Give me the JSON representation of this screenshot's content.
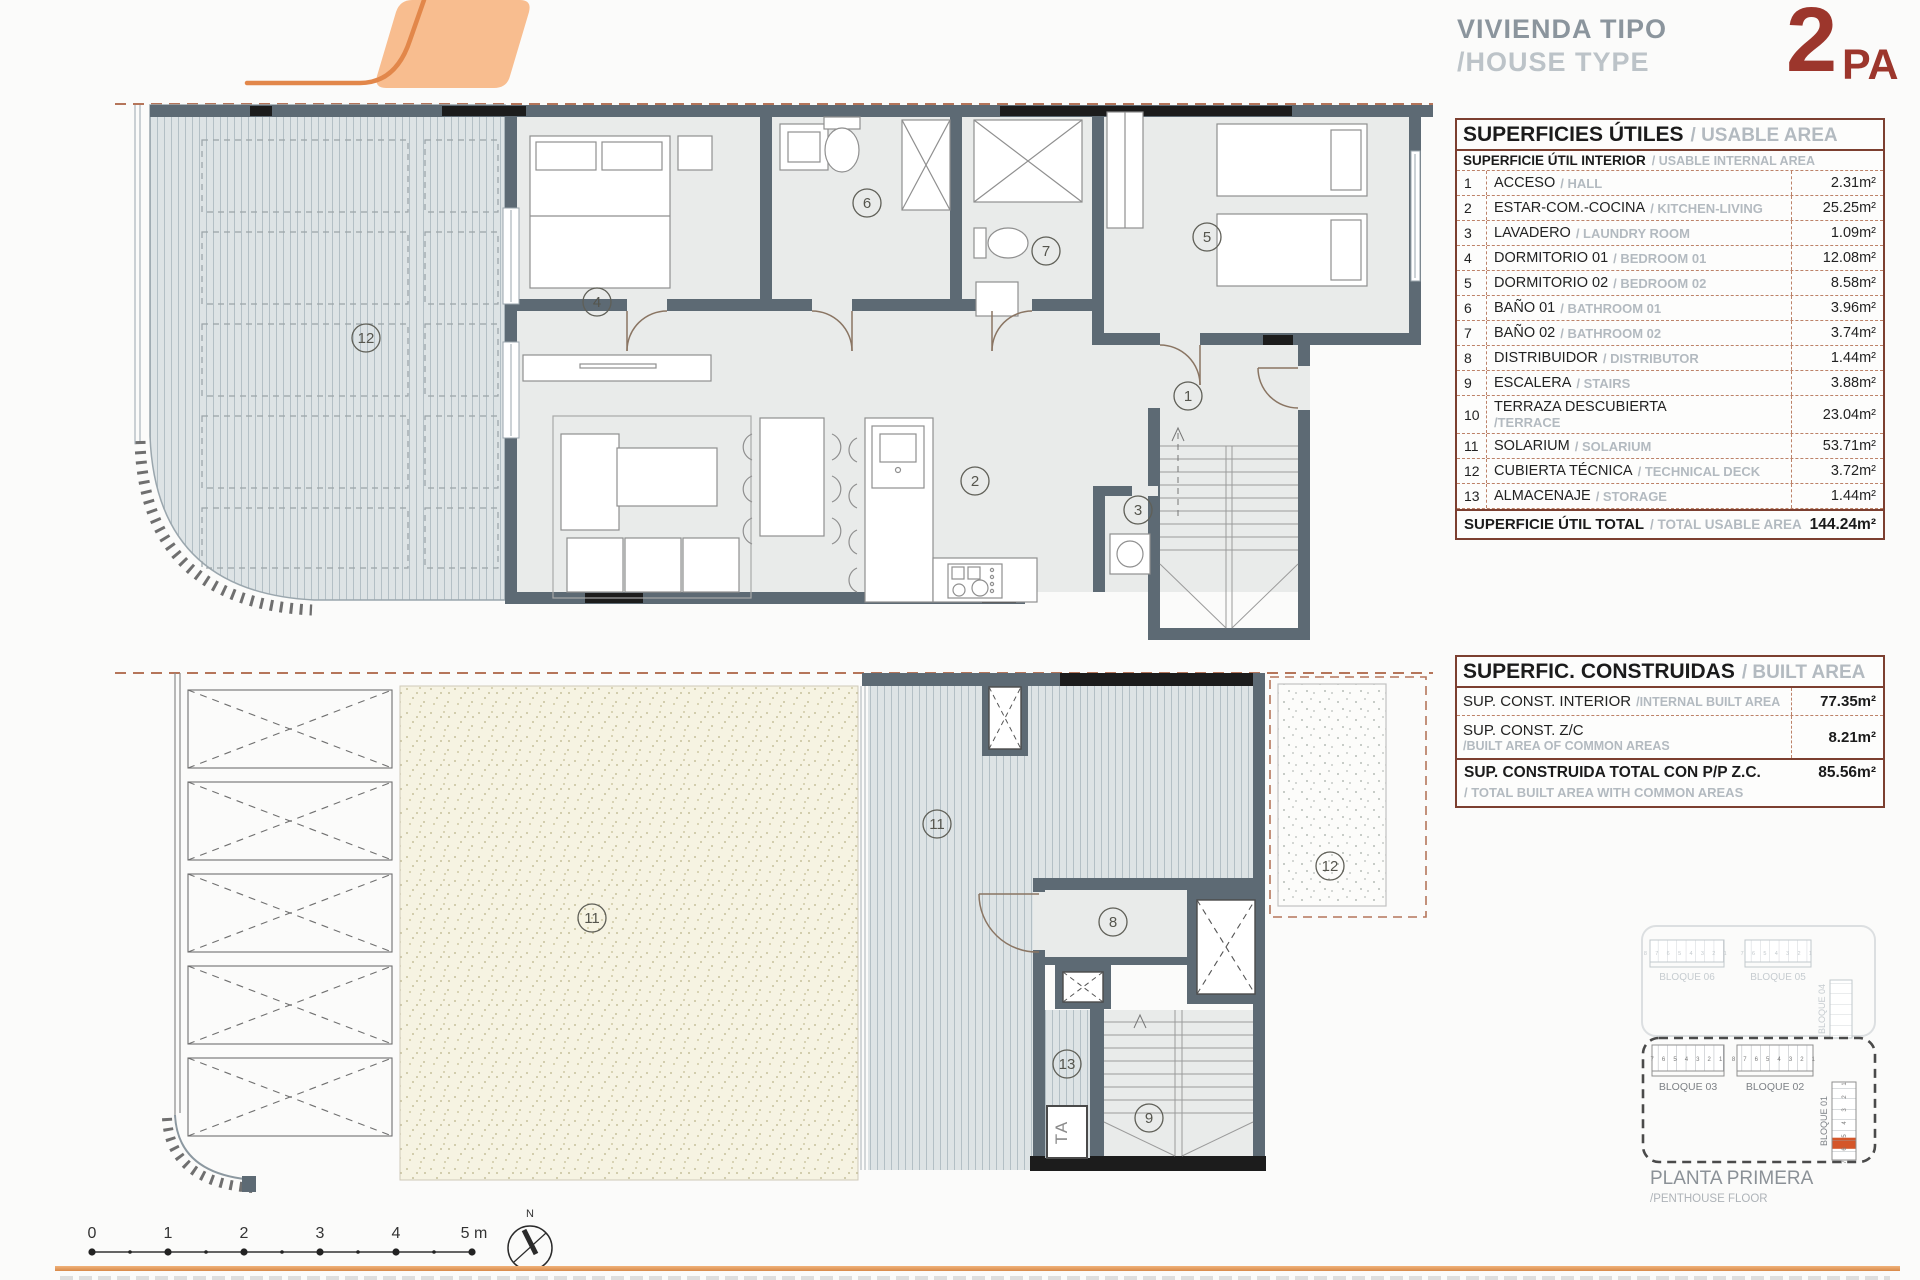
{
  "header": {
    "title_line1": "VIVIENDA TIPO",
    "title_line2": "/HOUSE TYPE",
    "type_number": "2",
    "type_suffix": "PA",
    "accent_red": "#9c362c",
    "accent_orange": "#e2874a"
  },
  "usable_table": {
    "title_es": "SUPERFICIES ÚTILES",
    "title_en": "/ USABLE AREA",
    "subtitle_es": "SUPERFICIE ÚTIL INTERIOR",
    "subtitle_en": "/ USABLE INTERNAL AREA",
    "rows": [
      {
        "num": "1",
        "es": "ACCESO",
        "en": "/ HALL",
        "value": "2.31m²"
      },
      {
        "num": "2",
        "es": "ESTAR-COM.-COCINA",
        "en": "/ KITCHEN-LIVING",
        "value": "25.25m²"
      },
      {
        "num": "3",
        "es": "LAVADERO",
        "en": "/ LAUNDRY ROOM",
        "value": "1.09m²"
      },
      {
        "num": "4",
        "es": "DORMITORIO 01",
        "en": "/ BEDROOM 01",
        "value": "12.08m²"
      },
      {
        "num": "5",
        "es": "DORMITORIO 02",
        "en": "/ BEDROOM 02",
        "value": "8.58m²"
      },
      {
        "num": "6",
        "es": "BAÑO 01",
        "en": "/ BATHROOM 01",
        "value": "3.96m²"
      },
      {
        "num": "7",
        "es": "BAÑO 02",
        "en": "/ BATHROOM 02",
        "value": "3.74m²"
      },
      {
        "num": "8",
        "es": "DISTRIBUIDOR",
        "en": "/ DISTRIBUTOR",
        "value": "1.44m²"
      },
      {
        "num": "9",
        "es": "ESCALERA",
        "en": "/ STAIRS",
        "value": "3.88m²"
      },
      {
        "num": "10",
        "es": "TERRAZA DESCUBIERTA",
        "en": "/TERRACE",
        "value": "23.04m²"
      },
      {
        "num": "11",
        "es": "SOLARIUM",
        "en": "/ SOLARIUM",
        "value": "53.71m²"
      },
      {
        "num": "12",
        "es": "CUBIERTA TÉCNICA",
        "en": "/ TECHNICAL DECK",
        "value": "3.72m²"
      },
      {
        "num": "13",
        "es": "ALMACENAJE",
        "en": "/ STORAGE",
        "value": "1.44m²"
      }
    ],
    "total_es": "SUPERFICIE ÚTIL TOTAL",
    "total_en": "/ TOTAL USABLE AREA",
    "total_value": "144.24m²"
  },
  "built_table": {
    "title_es": "SUPERFIC. CONSTRUIDAS",
    "title_en": "/ BUILT AREA",
    "row1_es": "SUP. CONST. INTERIOR",
    "row1_en": "/INTERNAL BUILT AREA",
    "row1_value": "77.35m²",
    "row2_es": "SUP. CONST. Z/C",
    "row2_en": "/BUILT AREA OF COMMON AREAS",
    "row2_value": "8.21m²",
    "total_es": "SUP. CONSTRUIDA TOTAL CON P/P Z.C.",
    "total_en": "/ TOTAL BUILT AREA WITH COMMON AREAS",
    "total_value": "85.56m²"
  },
  "plan_upper": {
    "deck": "12",
    "bedroom1": "4",
    "bath1": "6",
    "bath2": "7",
    "bedroom2": "5",
    "hall": "1",
    "living": "2",
    "laundry": "3"
  },
  "plan_lower": {
    "solarium_a": "11",
    "solarium_b": "11",
    "deck": "12",
    "distributor": "8",
    "stairs": "9",
    "storage": "13",
    "ta": "TA"
  },
  "key_plan": {
    "b06": "BLOQUE 06",
    "b06_units": "8 7 6 5 4 3 2 1",
    "b05": "BLOQUE 05",
    "b05_units": "7 6 5 4 3 2 1",
    "b04": "BLOQUE 04",
    "b03": "BLOQUE 03",
    "b03_units": "7 6 5 4 3 2 1",
    "b02": "BLOQUE 02",
    "b02_units": "8 7 6 5 4 3 2 1",
    "b01": "BLOQUE 01",
    "b01_units": "7 6 5 4 3 2 1",
    "highlight_color": "#d4562a",
    "floor_es": "PLANTA PRIMERA",
    "floor_en": "/PENTHOUSE FLOOR"
  },
  "scale_bar": {
    "labels": [
      "0",
      "1",
      "2",
      "3",
      "4",
      "5 m"
    ]
  },
  "compass": {
    "n": "N"
  }
}
